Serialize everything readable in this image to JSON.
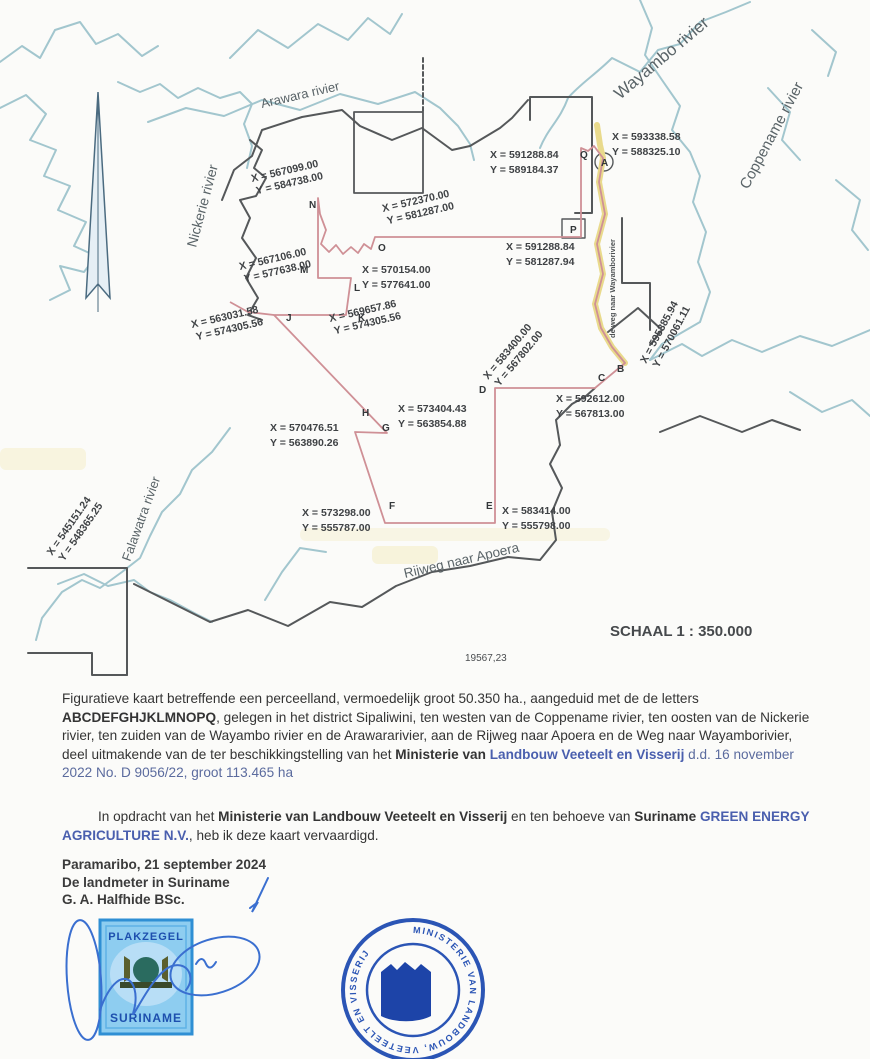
{
  "map": {
    "scale_label": "SCHAAL 1 : 350.000",
    "area_number": "19567,23",
    "rivers": {
      "arawara": "Arawara rivier",
      "wayambo": "Wayambo rivier",
      "coppename": "Coppename rivier",
      "nickerie": "Nickerie rivier",
      "falawatra": "Falawatra rivier"
    },
    "roads": {
      "apoera": "Rijweg naar Apoera",
      "wayambo_road": "de weg naar Wayamborivier"
    },
    "vertices": {
      "A": {
        "letter": "A",
        "x": "X = 593338.58",
        "y": "Y = 588325.10"
      },
      "B": {
        "letter": "B",
        "x": "X = 595385.94",
        "y": "Y = 570061.11"
      },
      "C": {
        "letter": "C",
        "x": "X = 592612.00",
        "y": "Y = 567813.00"
      },
      "D": {
        "letter": "D",
        "x": "X = 583400.00",
        "y": "Y = 567802.00"
      },
      "E": {
        "letter": "E",
        "x": "X = 583414.00",
        "y": "Y = 555798.00"
      },
      "F": {
        "letter": "F",
        "x": "X = 573298.00",
        "y": "Y = 555787.00"
      },
      "G": {
        "letter": "G",
        "x": "X = 570476.51",
        "y": "Y = 563890.26"
      },
      "H": {
        "letter": "H",
        "x": "X = 573404.43",
        "y": "Y = 563854.88"
      },
      "J": {
        "letter": "J",
        "x": "X = 563031.58",
        "y": "Y = 574305.56"
      },
      "K": {
        "letter": "K",
        "x": "X = 569657.86",
        "y": "Y = 574305.56"
      },
      "L": {
        "letter": "L",
        "x": "X = 570154.00",
        "y": "Y = 577641.00"
      },
      "M": {
        "letter": "M",
        "x": "X = 567106.00",
        "y": "Y = 577638.00"
      },
      "N": {
        "letter": "N",
        "x": "X = 567099.00",
        "y": "Y = 584738.00"
      },
      "O": {
        "letter": "O",
        "x": "X = 572370.00",
        "y": "Y = 581287.00"
      },
      "P": {
        "letter": "P",
        "x": "X = 591288.84",
        "y": "Y = 581287.94"
      },
      "Q": {
        "letter": "Q",
        "x": "X = 591288.84",
        "y": "Y = 589184.37"
      },
      "SW": {
        "x": "X = 545151.24",
        "y": "Y = 548365.25"
      }
    }
  },
  "paragraphs": {
    "p1": {
      "s1": "Figuratieve kaart betreffende een perceelland, vermoedelijk groot 50.350 ha., aangeduid met de de letters ",
      "s2": "ABCDEFGHJKLMNOPQ",
      "s3": ", gelegen in het district Sipaliwini, ten westen van de Coppename rivier, ten oosten van de Nickerie rivier, ten zuiden van de Wayambo rivier en de Arawararivier, aan de Rijweg naar Apoera en de Weg naar Wayamborivier, deel uitmakende van de ter beschikkingstelling van het ",
      "s4": "Ministerie van ",
      "s5": "Landbouw Veeteelt en Visserij",
      "s6": " d.d. 16 november 2022 No. D 9056/22, groot 113.465 ha"
    },
    "p2": {
      "s1": "In opdracht van het ",
      "s2": "Ministerie van Landbouw Veeteelt en Visserij",
      "s3": " en ten behoeve van ",
      "s4": "Suriname ",
      "s5": "GREEN ENERGY AGRICULTURE N.V.",
      "s6": ",  heb ik deze kaart vervaardigd."
    },
    "date_line": "Paramaribo, 21 september 2024",
    "surveyor_line": "De landmeter in Suriname",
    "name_line": "G. A. Halfhide BSc."
  },
  "stamps": {
    "plakzegel": {
      "top": "PLAKZEGEL",
      "bottom": "SURINAME"
    },
    "ministry": {
      "ring_text": "MINISTERIE VAN LANDBOUW, VEETEELT EN VISSERIJ"
    }
  },
  "colors": {
    "parcel_boundary": "#cf9096",
    "river": "#a2c6ce",
    "road_highlight": "#e9da8c",
    "ink_blue": "#4a5fae",
    "stamp_blue": "#2b55b5"
  }
}
